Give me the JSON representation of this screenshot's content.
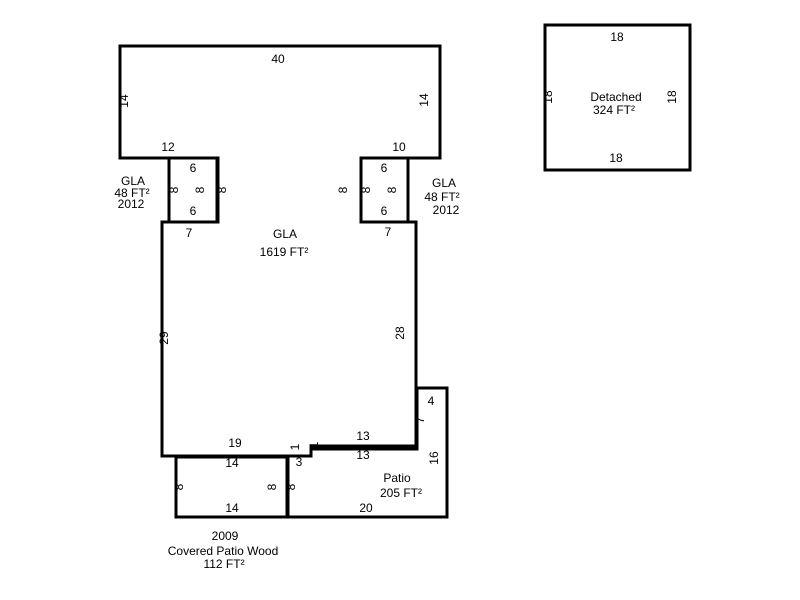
{
  "colors": {
    "line": "#000000",
    "background": "#ffffff"
  },
  "gla_main": {
    "caption": [
      "GLA",
      "1619 FT²"
    ],
    "dims": {
      "top": "40",
      "left_upper": "14",
      "right_upper": "14",
      "bottom_left_upper": "12",
      "bottom_right_upper": "10",
      "strip_west": "8",
      "strip_east": "8",
      "shoulder_left": "7",
      "shoulder_right": "7",
      "left_lower": "29",
      "right_lower": "28",
      "bottom_right": "13",
      "step": "1",
      "bottom_left": "19"
    }
  },
  "addition_left": {
    "caption": [
      "GLA",
      "48 FT²",
      "2012"
    ],
    "dims": {
      "top": "6",
      "left": "8",
      "right": "8",
      "bottom": "6"
    }
  },
  "addition_right": {
    "caption": [
      "GLA",
      "48 FT²",
      "2012"
    ],
    "dims": {
      "top": "6",
      "left": "8",
      "right": "8",
      "bottom": "6"
    }
  },
  "patio": {
    "caption": [
      "Patio",
      "205 FT²"
    ],
    "dims": {
      "bump_top": "4",
      "west_upper": "7",
      "east": "16",
      "top": "13",
      "step": "1",
      "top_left": "3",
      "west_lower": "8",
      "bottom": "20"
    }
  },
  "covered_patio": {
    "caption": [
      "2009",
      "Covered Patio Wood",
      "112 FT²"
    ],
    "dims": {
      "top": "14",
      "left": "8",
      "right": "8",
      "bottom": "14"
    }
  },
  "detached": {
    "caption": [
      "Detached",
      "324 FT²"
    ],
    "dims": {
      "top": "18",
      "left": "18",
      "right": "18",
      "bottom": "18"
    }
  }
}
